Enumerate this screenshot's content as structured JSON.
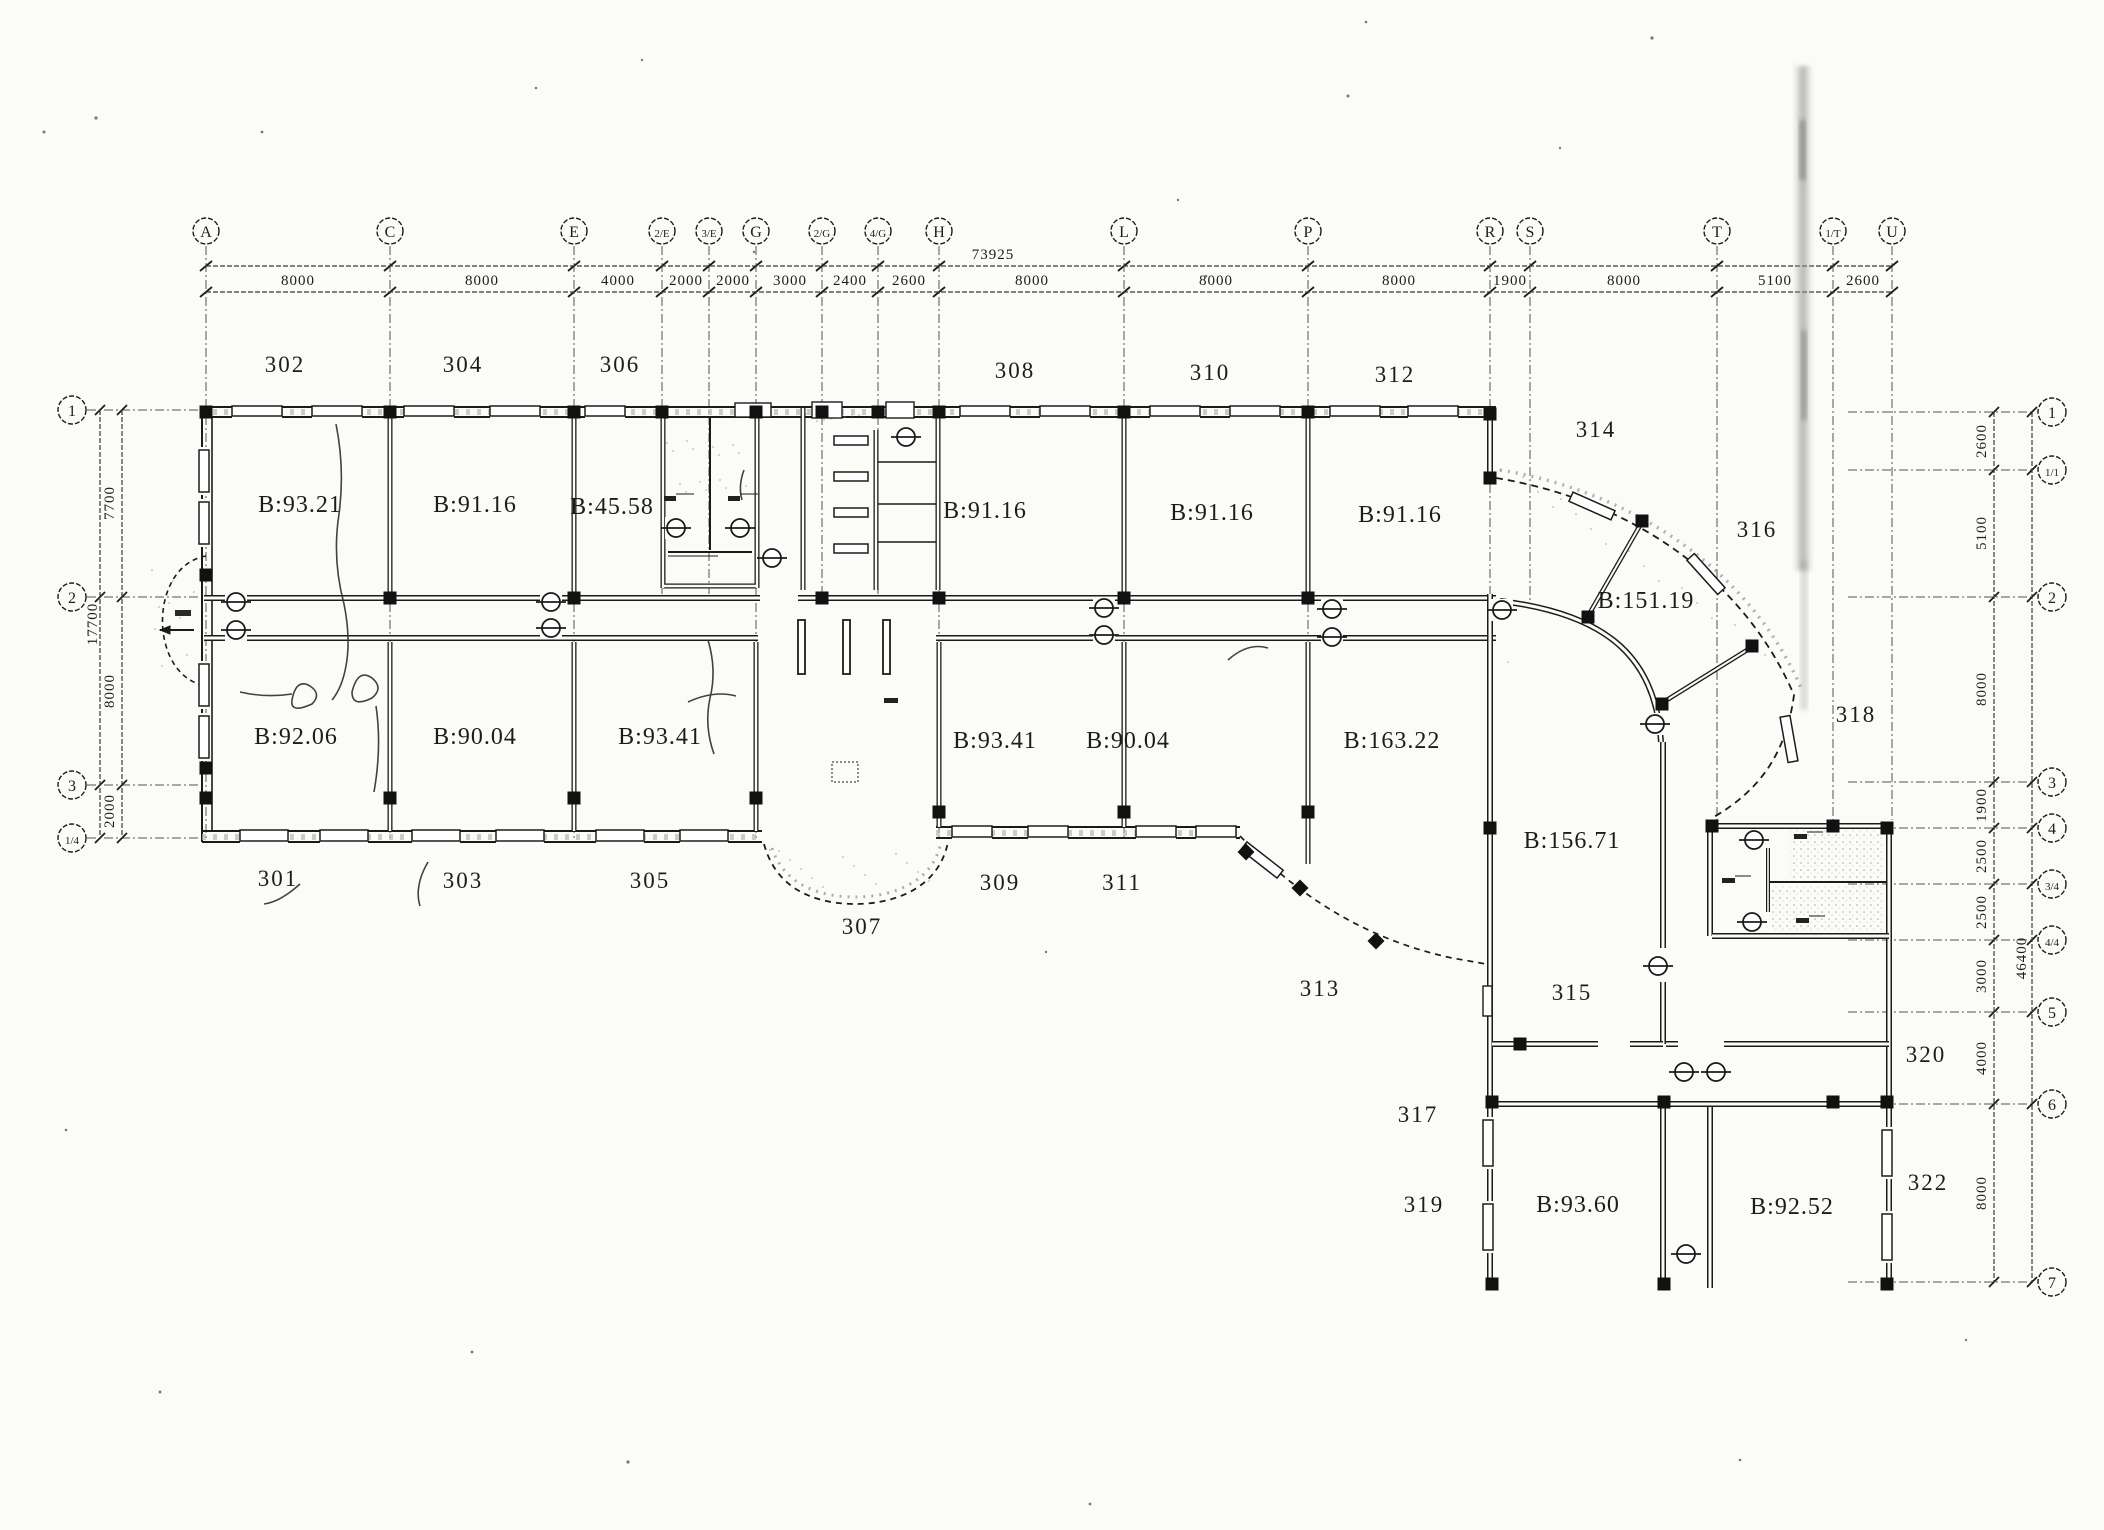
{
  "meta": {
    "drawing_type": "scanned architectural floor plan, third storey",
    "ink": "#1c1c1c"
  },
  "grid": {
    "top": [
      {
        "label": "A",
        "x": 206,
        "ext": 840
      },
      {
        "label": "C",
        "x": 390,
        "ext": 840
      },
      {
        "label": "E",
        "x": 574,
        "ext": 840
      },
      {
        "label": "2/E",
        "x": 662,
        "ext": 594
      },
      {
        "label": "3/E",
        "x": 709,
        "ext": 594
      },
      {
        "label": "G",
        "x": 756,
        "ext": 840
      },
      {
        "label": "2/G",
        "x": 822,
        "ext": 594
      },
      {
        "label": "4/G",
        "x": 878,
        "ext": 594
      },
      {
        "label": "H",
        "x": 939,
        "ext": 840
      },
      {
        "label": "L",
        "x": 1124,
        "ext": 840
      },
      {
        "label": "P",
        "x": 1308,
        "ext": 840
      },
      {
        "label": "R",
        "x": 1490,
        "ext": 600
      },
      {
        "label": "S",
        "x": 1530,
        "ext": 600
      },
      {
        "label": "T",
        "x": 1717,
        "ext": 820
      },
      {
        "label": "1/T",
        "x": 1833,
        "ext": 820
      },
      {
        "label": "U",
        "x": 1892,
        "ext": 820
      }
    ],
    "left": [
      {
        "label": "1",
        "y": 410
      },
      {
        "label": "2",
        "y": 597
      },
      {
        "label": "3",
        "y": 785
      },
      {
        "label": "1/4",
        "y": 838
      }
    ],
    "right": [
      {
        "label": "1",
        "y": 412
      },
      {
        "label": "1/1",
        "y": 470
      },
      {
        "label": "2",
        "y": 597
      },
      {
        "label": "3",
        "y": 782
      },
      {
        "label": "4",
        "y": 828
      },
      {
        "label": "3/4",
        "y": 884
      },
      {
        "label": "4/4",
        "y": 940
      },
      {
        "label": "5",
        "y": 1012
      },
      {
        "label": "6",
        "y": 1104
      },
      {
        "label": "7",
        "y": 1282
      }
    ]
  },
  "dimensions": {
    "top_overall": {
      "text": "73925",
      "x": 993,
      "y": 259
    },
    "top_segments": [
      {
        "text": "8000",
        "x": 298
      },
      {
        "text": "8000",
        "x": 482
      },
      {
        "text": "4000",
        "x": 618
      },
      {
        "text": "2000",
        "x": 686
      },
      {
        "text": "2000",
        "x": 733
      },
      {
        "text": "3000",
        "x": 790
      },
      {
        "text": "2400",
        "x": 850
      },
      {
        "text": "2600",
        "x": 909
      },
      {
        "text": "8000",
        "x": 1032
      },
      {
        "text": "8000",
        "x": 1216
      },
      {
        "text": "8000",
        "x": 1399
      },
      {
        "text": "1900",
        "x": 1510
      },
      {
        "text": "8000",
        "x": 1624
      },
      {
        "text": "5100",
        "x": 1775
      },
      {
        "text": "2600",
        "x": 1863
      }
    ],
    "left_overall": {
      "text": "17700",
      "x": 97,
      "y": 624
    },
    "left_segments": [
      {
        "text": "7700",
        "y": 503
      },
      {
        "text": "8000",
        "y": 691
      },
      {
        "text": "2000",
        "y": 811
      }
    ],
    "right_overall": {
      "text": "46400",
      "x": 2026,
      "y": 958
    },
    "right_segments": [
      {
        "text": "2600",
        "y": 441
      },
      {
        "text": "5100",
        "y": 533
      },
      {
        "text": "8000",
        "y": 689
      },
      {
        "text": "1900",
        "y": 805
      },
      {
        "text": "2500",
        "y": 856
      },
      {
        "text": "2500",
        "y": 912
      },
      {
        "text": "3000",
        "y": 976
      },
      {
        "text": "4000",
        "y": 1058
      },
      {
        "text": "8000",
        "y": 1193
      }
    ]
  },
  "rooms": {
    "numbers": [
      {
        "text": "302",
        "x": 285,
        "y": 372
      },
      {
        "text": "304",
        "x": 463,
        "y": 372
      },
      {
        "text": "306",
        "x": 620,
        "y": 372
      },
      {
        "text": "308",
        "x": 1015,
        "y": 378
      },
      {
        "text": "310",
        "x": 1210,
        "y": 380
      },
      {
        "text": "312",
        "x": 1395,
        "y": 382
      },
      {
        "text": "301",
        "x": 278,
        "y": 886
      },
      {
        "text": "303",
        "x": 463,
        "y": 888
      },
      {
        "text": "305",
        "x": 650,
        "y": 888
      },
      {
        "text": "307",
        "x": 862,
        "y": 934
      },
      {
        "text": "309",
        "x": 1000,
        "y": 890
      },
      {
        "text": "311",
        "x": 1122,
        "y": 890
      },
      {
        "text": "313",
        "x": 1320,
        "y": 996
      },
      {
        "text": "314",
        "x": 1596,
        "y": 437
      },
      {
        "text": "315",
        "x": 1572,
        "y": 1000
      },
      {
        "text": "316",
        "x": 1757,
        "y": 537
      },
      {
        "text": "317",
        "x": 1418,
        "y": 1122
      },
      {
        "text": "318",
        "x": 1856,
        "y": 722
      },
      {
        "text": "319",
        "x": 1424,
        "y": 1212
      },
      {
        "text": "320",
        "x": 1926,
        "y": 1062
      },
      {
        "text": "322",
        "x": 1928,
        "y": 1190
      }
    ],
    "areas": [
      {
        "text": "B:93.21",
        "x": 300,
        "y": 512
      },
      {
        "text": "B:91.16",
        "x": 475,
        "y": 512
      },
      {
        "text": "B:45.58",
        "x": 612,
        "y": 514
      },
      {
        "text": "B:91.16",
        "x": 985,
        "y": 518
      },
      {
        "text": "B:91.16",
        "x": 1212,
        "y": 520
      },
      {
        "text": "B:91.16",
        "x": 1400,
        "y": 522
      },
      {
        "text": "B:92.06",
        "x": 296,
        "y": 744
      },
      {
        "text": "B:90.04",
        "x": 475,
        "y": 744
      },
      {
        "text": "B:93.41",
        "x": 660,
        "y": 744
      },
      {
        "text": "B:93.41",
        "x": 995,
        "y": 748
      },
      {
        "text": "B:90.04",
        "x": 1128,
        "y": 748
      },
      {
        "text": "B:163.22",
        "x": 1392,
        "y": 748
      },
      {
        "text": "B:151.19",
        "x": 1646,
        "y": 608
      },
      {
        "text": "B:156.71",
        "x": 1572,
        "y": 848
      },
      {
        "text": "B:93.60",
        "x": 1578,
        "y": 1212
      },
      {
        "text": "B:92.52",
        "x": 1792,
        "y": 1214
      }
    ]
  },
  "symbols": {
    "doors": [
      [
        236,
        602
      ],
      [
        236,
        630
      ],
      [
        551,
        602
      ],
      [
        551,
        628
      ],
      [
        772,
        558
      ],
      [
        1104,
        608
      ],
      [
        1104,
        635
      ],
      [
        1332,
        609
      ],
      [
        1332,
        637
      ],
      [
        1502,
        610
      ],
      [
        676,
        528
      ],
      [
        740,
        528
      ],
      [
        906,
        437
      ],
      [
        1754,
        840
      ],
      [
        1752,
        922
      ],
      [
        1658,
        966
      ],
      [
        1655,
        724
      ],
      [
        1684,
        1072
      ],
      [
        1716,
        1072
      ],
      [
        1686,
        1254
      ]
    ],
    "columns": [
      [
        206,
        412
      ],
      [
        390,
        412
      ],
      [
        574,
        412
      ],
      [
        662,
        412
      ],
      [
        756,
        412
      ],
      [
        822,
        412
      ],
      [
        878,
        412
      ],
      [
        939,
        412
      ],
      [
        1124,
        412
      ],
      [
        1308,
        412
      ],
      [
        1490,
        414
      ],
      [
        390,
        598
      ],
      [
        574,
        598
      ],
      [
        822,
        598
      ],
      [
        939,
        598
      ],
      [
        1124,
        598
      ],
      [
        1308,
        598
      ],
      [
        206,
        575
      ],
      [
        206,
        768
      ],
      [
        206,
        798
      ],
      [
        390,
        798
      ],
      [
        574,
        798
      ],
      [
        756,
        798
      ],
      [
        939,
        812
      ],
      [
        1124,
        812
      ],
      [
        1308,
        812
      ],
      [
        1490,
        478
      ],
      [
        1642,
        521
      ],
      [
        1588,
        617
      ],
      [
        1752,
        646
      ],
      [
        1662,
        704
      ],
      [
        1490,
        828
      ],
      [
        1712,
        826
      ],
      [
        1833,
        826
      ],
      [
        1887,
        828
      ],
      [
        1520,
        1044
      ],
      [
        1492,
        1102
      ],
      [
        1664,
        1102
      ],
      [
        1833,
        1102
      ],
      [
        1887,
        1102
      ],
      [
        1492,
        1284
      ],
      [
        1664,
        1284
      ],
      [
        1887,
        1284
      ]
    ],
    "diamonds": [
      [
        1246,
        852
      ],
      [
        1300,
        888
      ],
      [
        1376,
        941
      ]
    ]
  },
  "windows": {
    "top_wall": [
      {
        "x": 232
      },
      {
        "x": 312
      },
      {
        "x": 404
      },
      {
        "x": 490
      },
      {
        "x": 585,
        "w": 40
      },
      {
        "x": 960
      },
      {
        "x": 1040
      },
      {
        "x": 1150
      },
      {
        "x": 1230
      },
      {
        "x": 1330
      },
      {
        "x": 1408
      }
    ],
    "bottom_left": [
      {
        "x": 240
      },
      {
        "x": 320
      },
      {
        "x": 412
      },
      {
        "x": 496
      },
      {
        "x": 596
      },
      {
        "x": 680
      }
    ],
    "bottom_mid": [
      {
        "x": 952
      },
      {
        "x": 1028
      },
      {
        "x": 1136
      },
      {
        "x": 1196
      }
    ],
    "left_wall_y": [
      450,
      502,
      664,
      716
    ],
    "west_wing_y": [
      1120,
      1204
    ],
    "east_wing_y": [
      1130,
      1214
    ],
    "curve": [
      {
        "x": 1592,
        "y": 506,
        "r": 24
      },
      {
        "x": 1706,
        "y": 574,
        "r": 48
      },
      {
        "x": 1789,
        "y": 739,
        "r": 80
      },
      {
        "x": 1262,
        "y": 860,
        "r": 38
      }
    ],
    "door_leafs": [
      {
        "x": 1483,
        "y": 986,
        "w": 9,
        "h": 30
      },
      {
        "x": 735,
        "y": 403,
        "w": 36,
        "h": 14
      },
      {
        "x": 812,
        "y": 402,
        "w": 30,
        "h": 16
      },
      {
        "x": 886,
        "y": 402,
        "w": 28,
        "h": 16
      }
    ]
  }
}
